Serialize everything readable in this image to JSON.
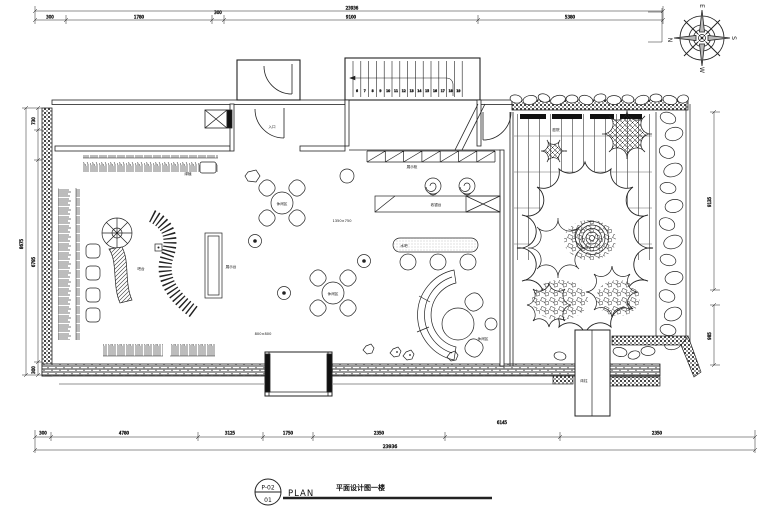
{
  "title_block": {
    "sheet_code": "P-02",
    "detail_number": "01",
    "plan_word": "PLAN",
    "drawing_title": "平面设计图一楼"
  },
  "compass": {
    "top": "E",
    "left": "N",
    "right": "S",
    "bottom": "W"
  },
  "stairs": {
    "numbers": [
      "6",
      "7",
      "8",
      "9",
      "10",
      "11",
      "12",
      "13",
      "14",
      "15",
      "16",
      "17",
      "18",
      "19"
    ]
  },
  "dimensions": {
    "top_overall": "23936",
    "top_segments": [
      "300",
      "1780",
      "300",
      "9100",
      "5380"
    ],
    "bottom_segments": [
      "300",
      "4780",
      "3125",
      "1750",
      "2350",
      "6145",
      "2350"
    ],
    "bottom_overall": "23936",
    "left_segments": [
      "730",
      "6795",
      "300"
    ],
    "left_overall": "8675",
    "right_upper": "9135",
    "right_lower": "985"
  },
  "area_labels": {
    "shelving": "展示柜",
    "plants_top": "绿植",
    "bar": "吧台",
    "display_table": "展示台",
    "leisure_a": "休闲区",
    "leisure_b": "休闲区",
    "cashier": "收银台",
    "water_bar": "水吧",
    "lounge": "休闲区",
    "courtyard": "庭院",
    "entrance": "入口",
    "pier": "砖柱",
    "spec_a": "1350×750",
    "spec_b": "800×800"
  }
}
